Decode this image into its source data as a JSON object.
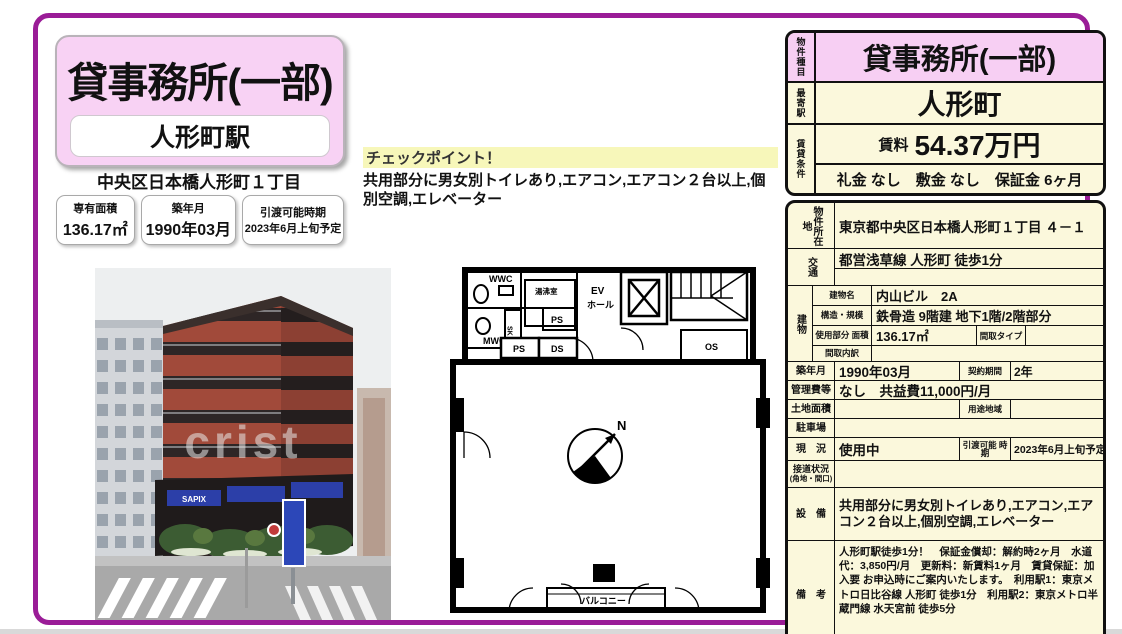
{
  "colors": {
    "accent": "#9a1c97",
    "pink": "#f8d2f4",
    "cream": "#fbf8dc",
    "sign_blue": "#2c3fa8"
  },
  "left": {
    "title": "貸事務所(一部)",
    "station": "人形町駅",
    "address": "中央区日本橋人形町１丁目",
    "badges": [
      {
        "label": "専有面積",
        "value": "136.17㎡"
      },
      {
        "label": "築年月",
        "value": "1990年03月"
      },
      {
        "label": "引渡可能時期",
        "value": "2023年6月上旬予定"
      }
    ],
    "photo": {
      "watermark": "crist",
      "sign_text": "SAPIX"
    }
  },
  "checkpoint": {
    "title": "チェックポイント！",
    "body": "共用部分に男女別トイレあり,エアコン,エアコン２台以上,個別空調,エレベーター"
  },
  "floorplan": {
    "labels": {
      "wwc": "WWC",
      "mwc": "MWC",
      "yuwakashi": "湯沸室",
      "sk": "SK",
      "ps_small": "PS",
      "ev_line1": "EV",
      "ev_line2": "ホール",
      "os": "OS",
      "ps": "PS",
      "ds": "DS",
      "north": "N",
      "balcony": "バルコニー"
    }
  },
  "right": {
    "summary": {
      "type_label": "物件種目",
      "type_value": "貸事務所(一部)",
      "station_label": "最寄駅",
      "station_value": "人形町",
      "terms_label": "賃貸条件",
      "rent_label": "賃料",
      "rent_value": "54.37万円",
      "terms_line": "礼金 なし　敷金 なし　保証金 6ヶ月"
    },
    "details": {
      "location_label": "物件所在地",
      "location_value": "東京都中央区日本橋人形町１丁目 ４－１",
      "access_label": "交通",
      "access_value": "都営浅草線 人形町 徒歩1分",
      "building_label": "建物",
      "building_rows": [
        {
          "label": "建物名",
          "value": "内山ビル　2A"
        },
        {
          "label": "構造・規模",
          "value": "鉄骨造 9階建 地下1階/2階部分"
        },
        {
          "label": "使用部分 面積",
          "value": "136.17㎡",
          "label2": "間取タイプ",
          "value2": ""
        },
        {
          "label": "間取内訳",
          "value": ""
        }
      ],
      "built_label": "築年月",
      "built_value": "1990年03月",
      "contract_label": "契約期間",
      "contract_value": "2年",
      "fees_label": "管理費等",
      "fees_value": "なし　共益費11,000円/月",
      "land_label": "土地面積",
      "land_value": "",
      "zone_label": "用途地域",
      "zone_value": "",
      "parking_label": "駐車場",
      "parking_value": "",
      "status_label": "現　況",
      "status_value": "使用中",
      "handover_label": "引渡可能 時期",
      "handover_value": "2023年6月上旬予定",
      "road_label": "接道状況",
      "road_sublabel": "(角地・間口)",
      "road_value": "",
      "equipment_label": "設　備",
      "equipment_value": "共用部分に男女別トイレあり,エアコン,エアコン２台以上,個別空調,エレベーター",
      "remarks_label": "備　考",
      "remarks_value": "人形町駅徒歩1分！　保証金償却：解約時2ヶ月　水道代：3,850円/月　更新料：新賃料1ヶ月　賃貸保証：加入要 お申込時にご案内いたします。　利用駅1：東京メトロ日比谷線 人形町 徒歩1分　利用駅2：東京メトロ半蔵門線 水天宮前 徒歩5分"
    }
  }
}
